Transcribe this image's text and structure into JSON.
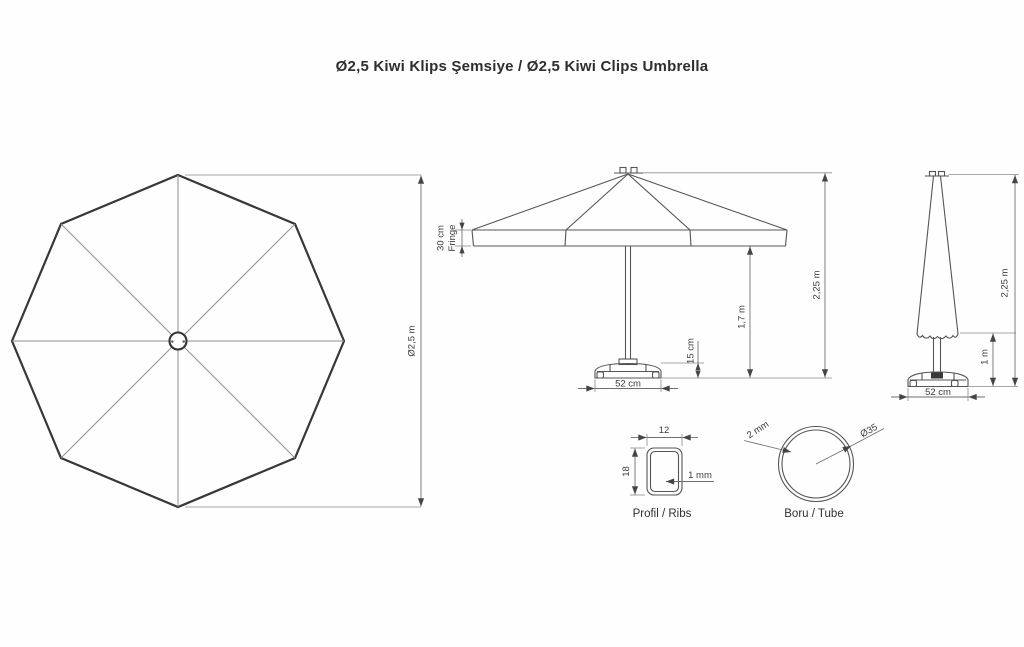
{
  "title": "Ø2,5 Kiwi Klips Şemsiye / Ø2,5 Kiwi Clips Umbrella",
  "top_view": {
    "diameter_label": "Ø2,5 m"
  },
  "front_view": {
    "fringe_size_label": "30 cm",
    "fringe_word_label": "Fringe",
    "base_height_label": "15 cm",
    "clearance_label": "1,7 m",
    "total_height_label": "2,25 m",
    "base_width_label": "52 cm"
  },
  "side_view": {
    "total_height_label": "2,25 m",
    "closed_canopy_label": "1 m",
    "base_width_label": "52 cm"
  },
  "profile_detail": {
    "width_label": "12",
    "height_label": "18",
    "wall_label": "1 mm",
    "caption": "Profil / Ribs"
  },
  "tube_detail": {
    "wall_label": "2 mm",
    "diameter_label": "Ø35",
    "caption": "Boru / Tube"
  }
}
